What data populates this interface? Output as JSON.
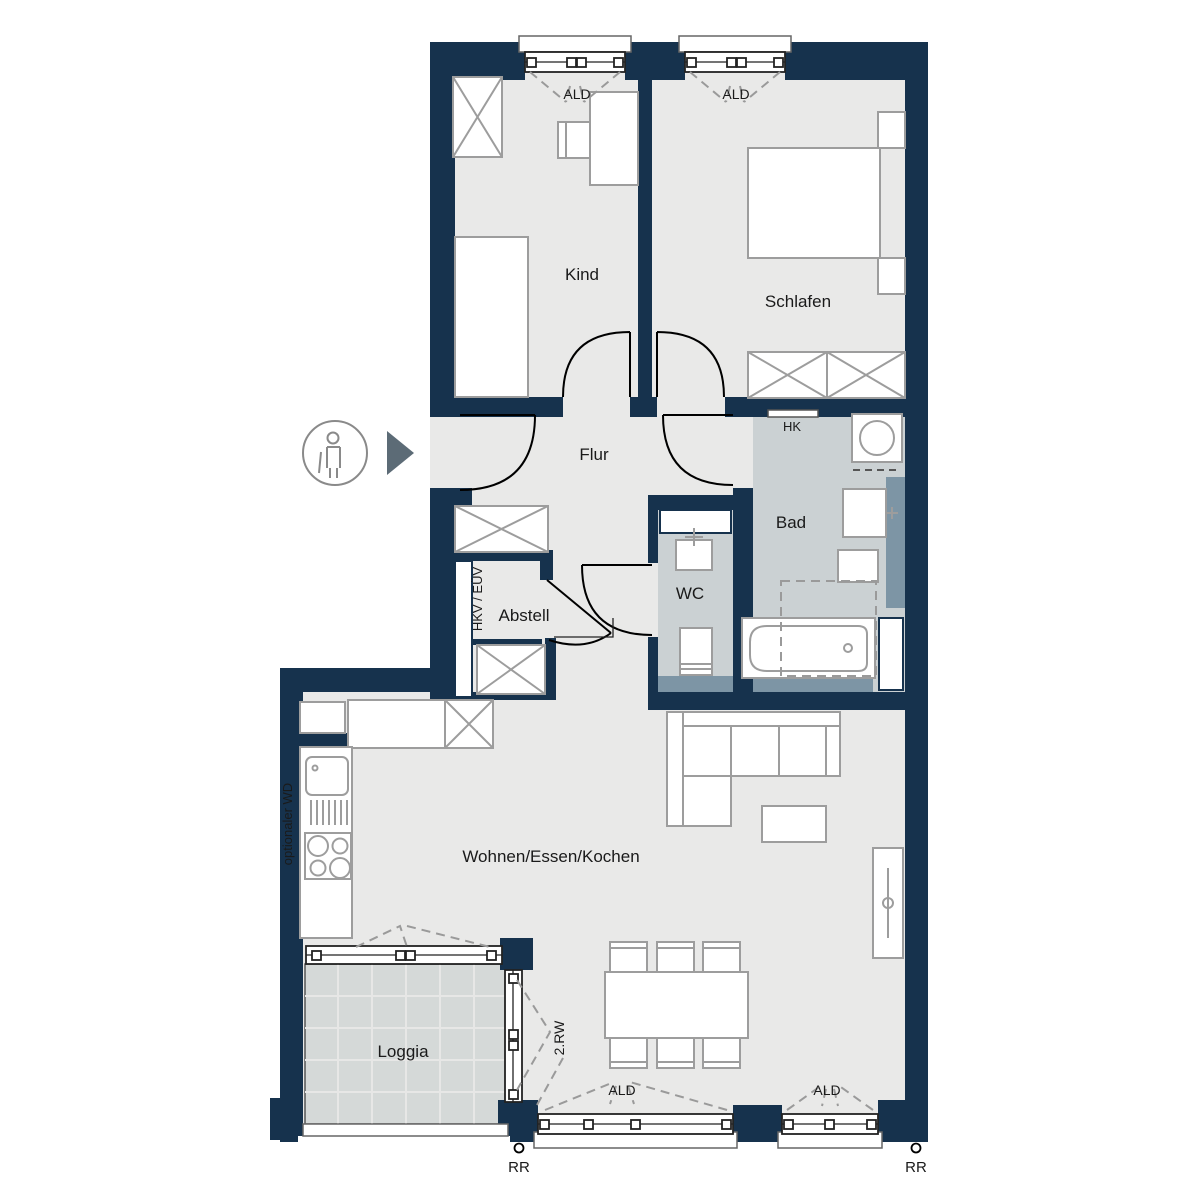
{
  "colors": {
    "wall": "#16324d",
    "floor": "#e9e9e8",
    "wet_floor": "#cbd1d3",
    "loggia_tile": "#d5d9d8",
    "install_band": "#7d95a5",
    "furniture_outline": "#9d9d9d",
    "door_swing": "#000000",
    "dashed_lines": "#9a9a9a",
    "entry_arrow": "#5c6b76",
    "label_text": "#1a1a1a"
  },
  "rooms": {
    "kind": "Kind",
    "schlafen": "Schlafen",
    "flur": "Flur",
    "bad": "Bad",
    "wc": "WC",
    "abstell": "Abstell",
    "wohnen": "Wohnen/Essen/Kochen",
    "loggia": "Loggia"
  },
  "annotations": {
    "ald": "ALD",
    "hk": "HK",
    "rr": "RR",
    "second_escape": "2.RW",
    "shaft": "HKV / EÜV",
    "optional_washer": "optionaler WD"
  }
}
